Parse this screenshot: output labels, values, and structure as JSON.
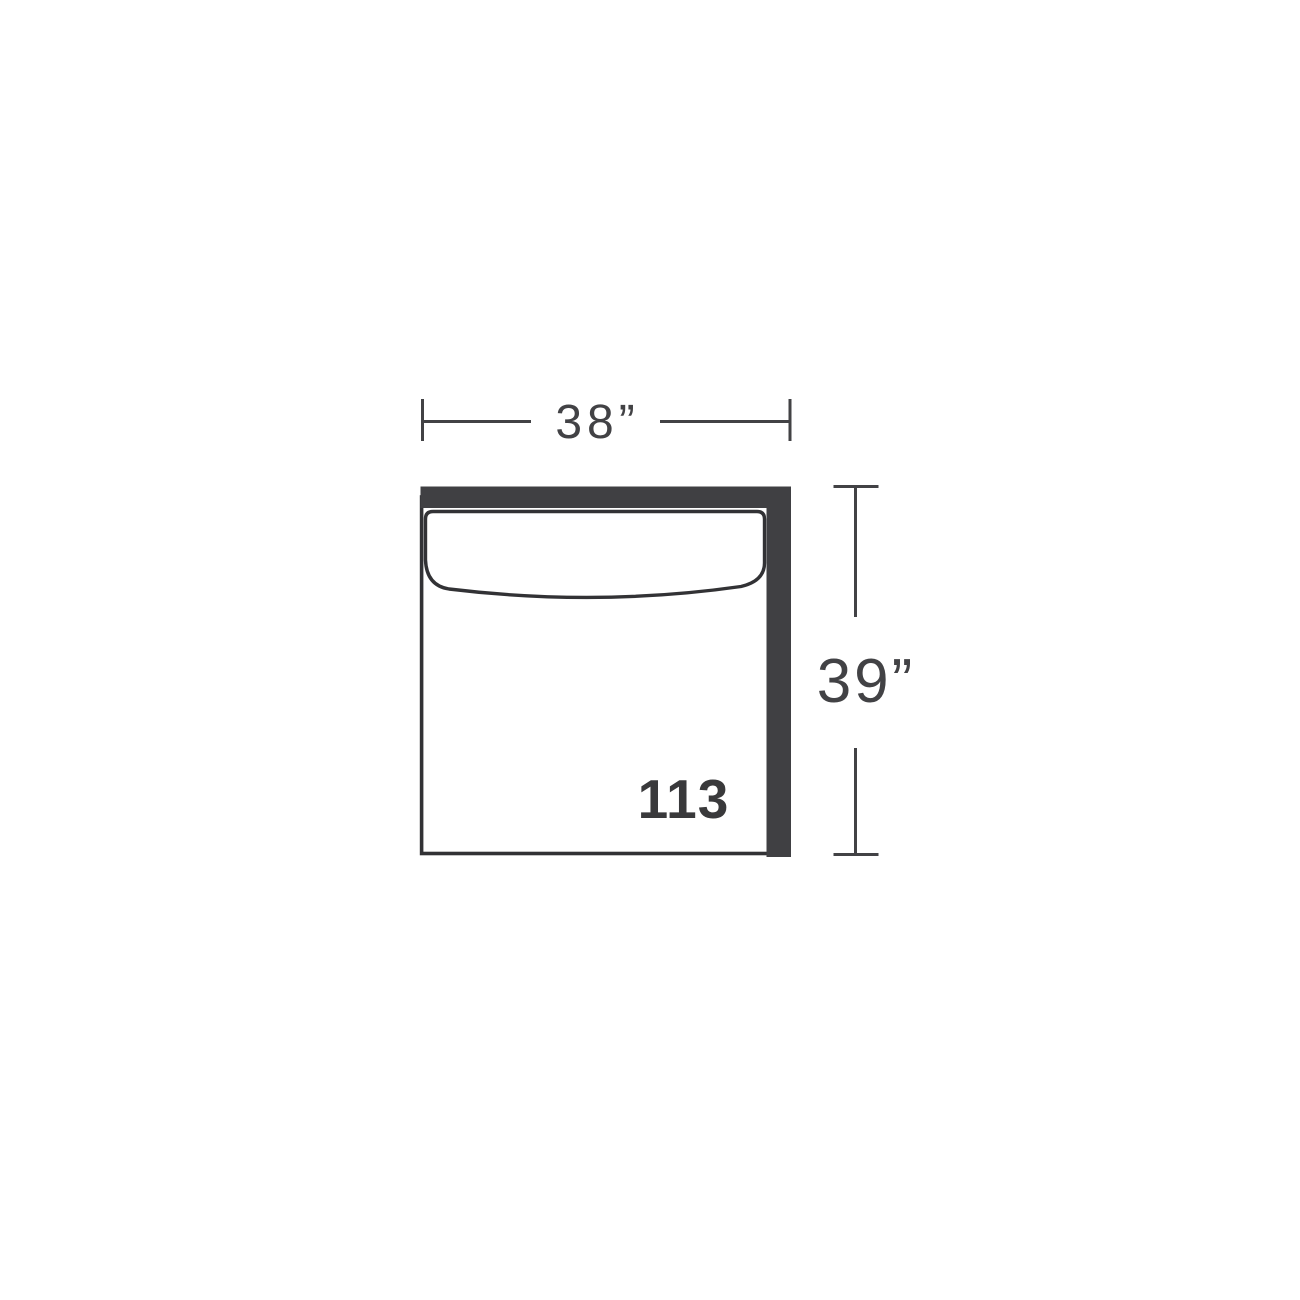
{
  "diagram": {
    "module_number": "113",
    "width_dimension": {
      "label": "38”"
    },
    "height_dimension": {
      "label": "39”"
    },
    "colors": {
      "background": "#ffffff",
      "bar_fill": "#404043",
      "outline": "#323235",
      "dimension_line": "#424245",
      "module_label": "#39393b"
    }
  }
}
